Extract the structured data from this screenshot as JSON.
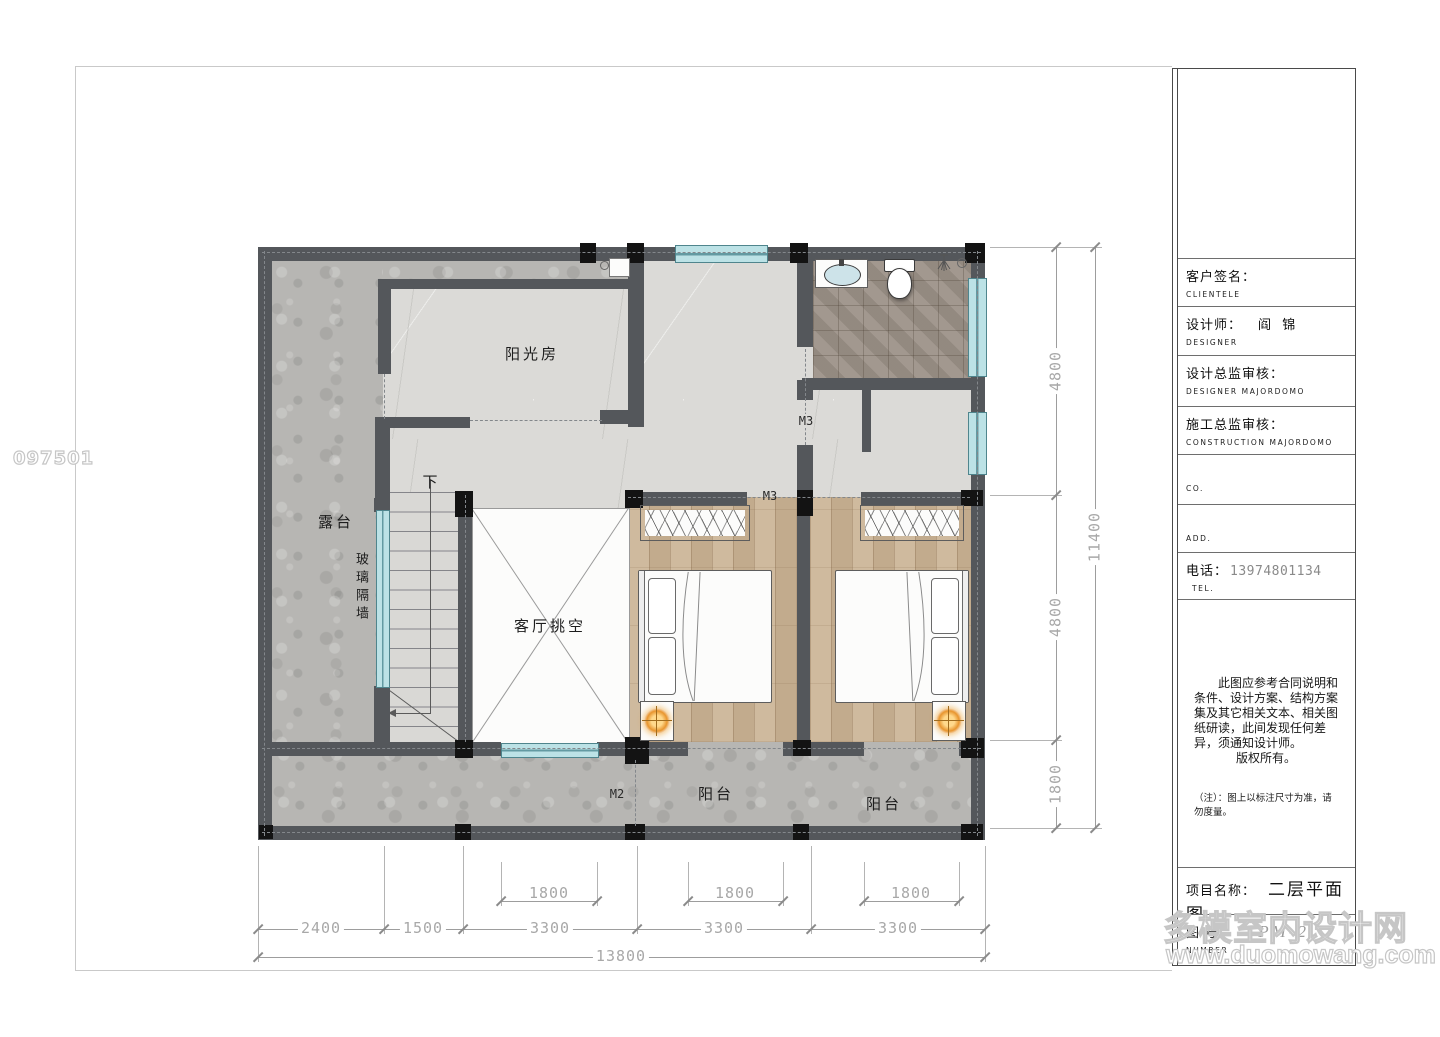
{
  "page": {
    "code": "097501"
  },
  "watermark": {
    "line1": "多模室内设计网",
    "line2": "www.duomowang.com",
    "outline_color": "#c6c6c6"
  },
  "plan": {
    "rooms": {
      "sunroom": "阳光房",
      "terrace": "露台",
      "glass_wall": "玻璃隔墙",
      "living_void": "客厅挑空",
      "balcony_left": "阳台",
      "balcony_right": "阳台",
      "stairs_down": "下"
    },
    "doors": {
      "m2": "M2",
      "m3_hall": "M3",
      "m3_bedroom": "M3"
    },
    "dims": {
      "bottom_openings": [
        "1800",
        "1800",
        "1800"
      ],
      "bottom_segments": [
        "2400",
        "1500",
        "3300",
        "3300",
        "3300"
      ],
      "bottom_total": "13800",
      "right_segments": [
        "4800",
        "4800",
        "1800"
      ],
      "right_total": "11400"
    }
  },
  "title_block": {
    "rows": [
      {
        "label": "客户签名：",
        "sub": "CLIENTELE",
        "value": ""
      },
      {
        "label": "设计师：",
        "sub": "DESIGNER",
        "value": "阎  锦"
      },
      {
        "label": "设计总监审核：",
        "sub": "DESIGNER  MAJORDOMO",
        "value": ""
      },
      {
        "label": "施工总监审核：",
        "sub": "CONSTRUCTION  MAJORDOMO",
        "value": ""
      },
      {
        "label": "",
        "sub": "CO.",
        "value": ""
      },
      {
        "label": "",
        "sub": "ADD.",
        "value": ""
      },
      {
        "label": "电话：",
        "sub": "TEL.",
        "value": "13974801134"
      }
    ],
    "notes_par": "此图应参考合同说明和条件、设计方案、结构方案集及其它相关文本、相关图纸研读，此间发现任何差异，须通知设计师。",
    "notes_copyright": "版权所有。",
    "notes_remark": "（注）：图上以标注尺寸为准，请勿度量。",
    "project_label": "项目名称：",
    "project_sub": "PROJECT",
    "project_value": "二层平面图",
    "number_label": "图  号：",
    "number_sub": "NUMBER",
    "number_value": "PM-2"
  }
}
